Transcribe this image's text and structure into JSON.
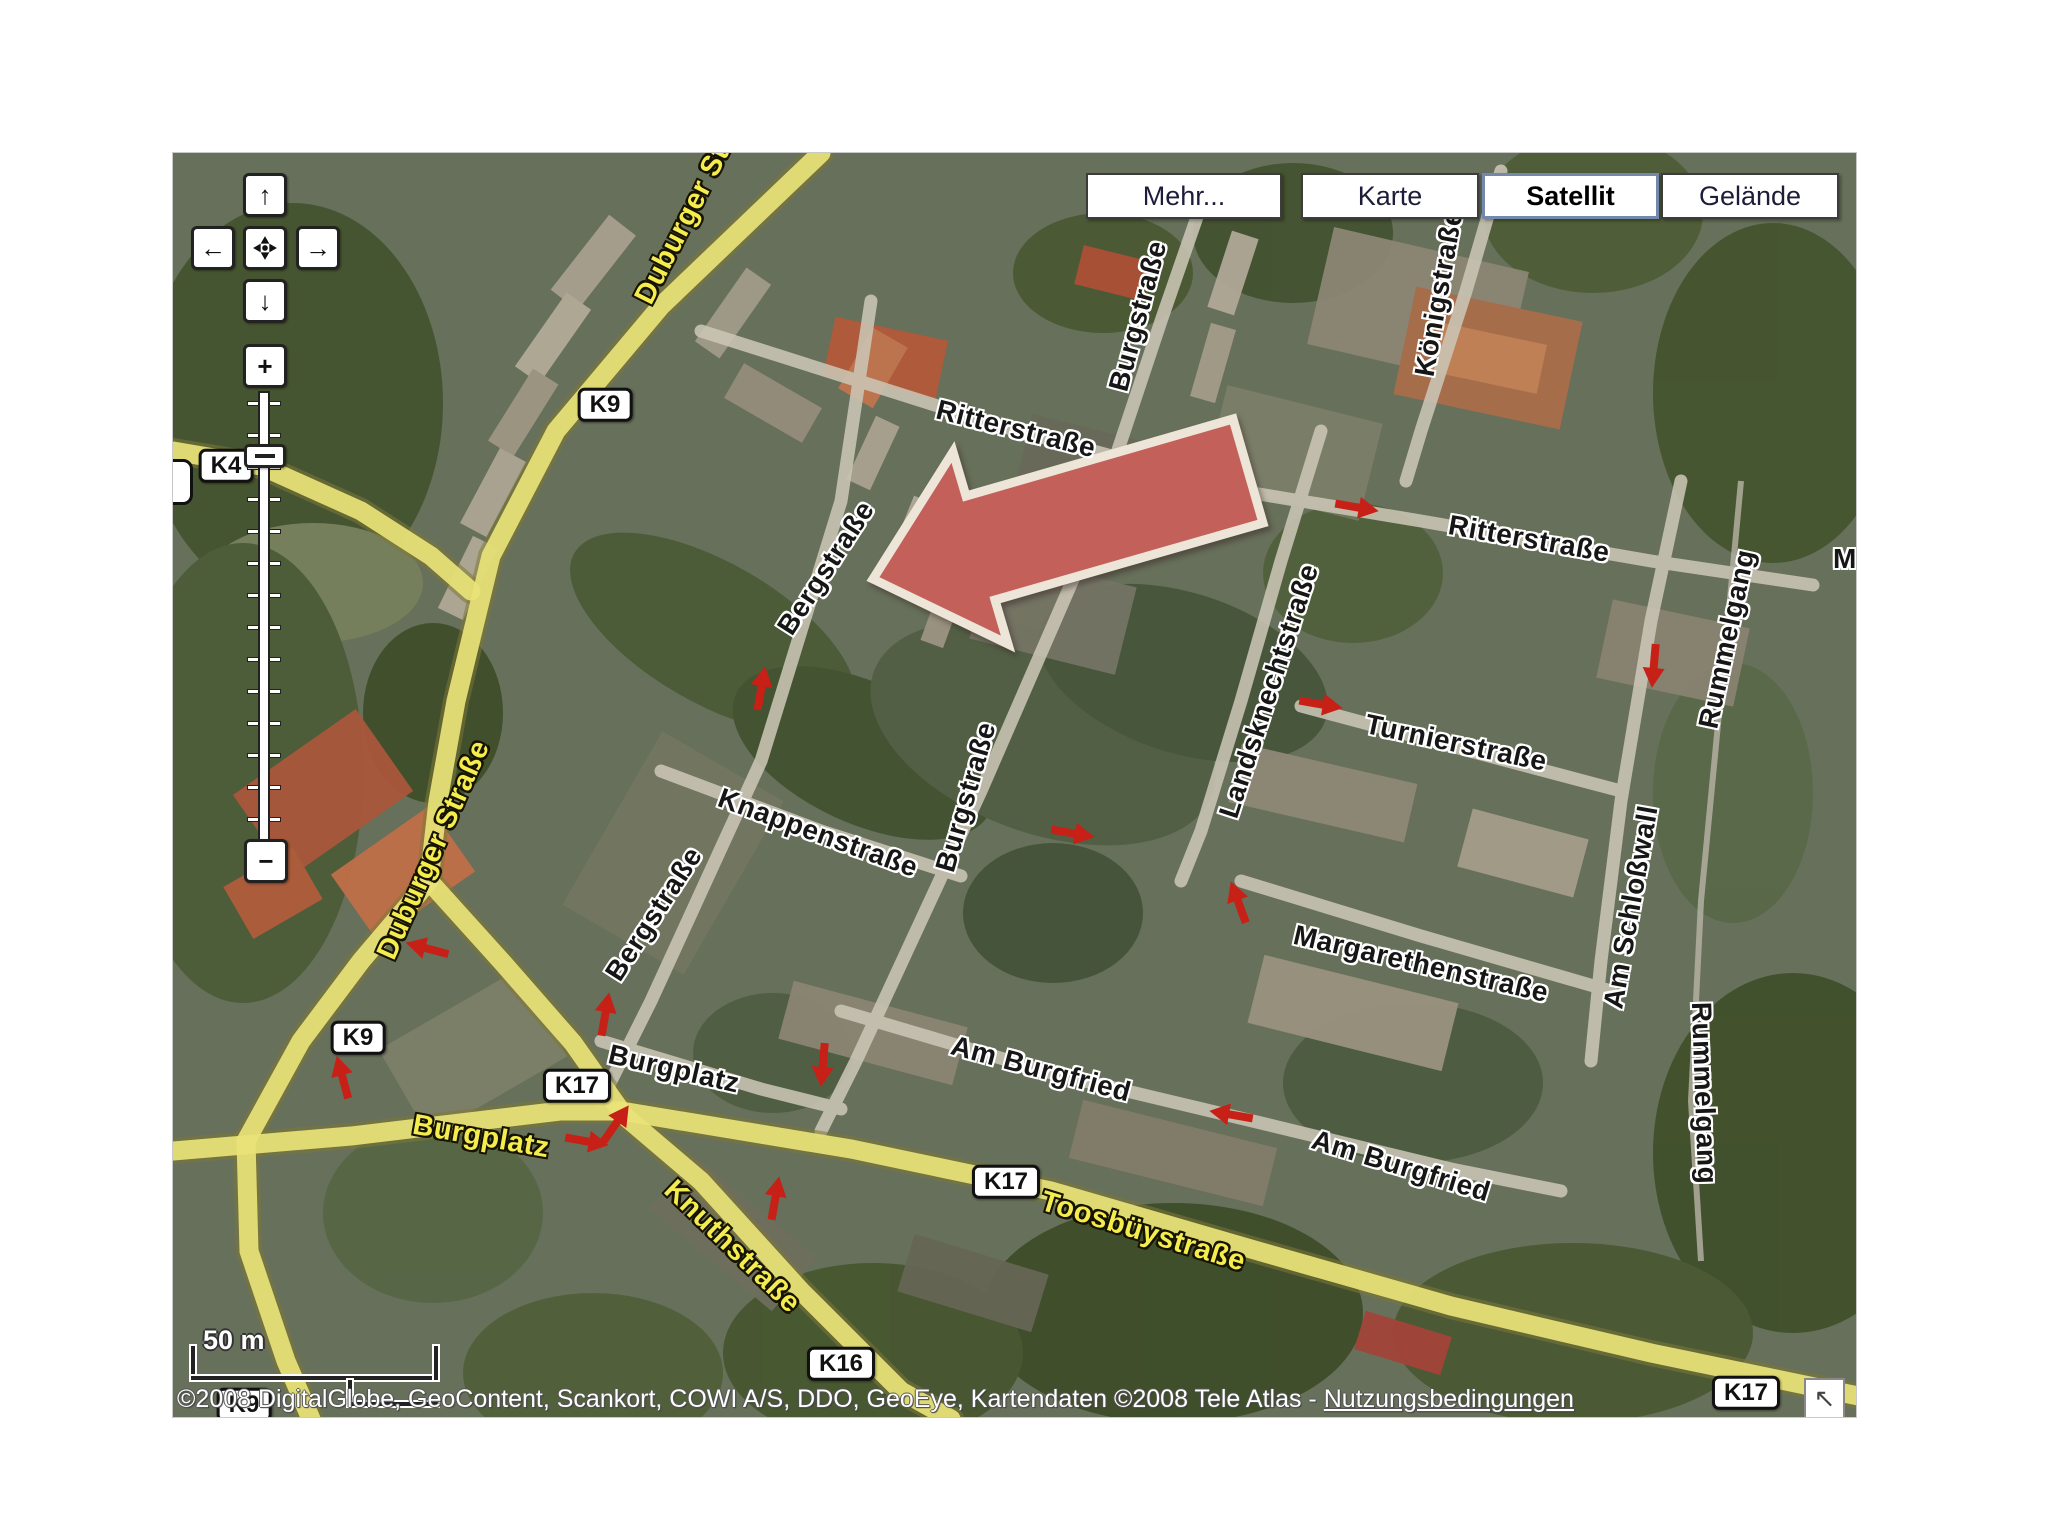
{
  "layer_buttons": [
    {
      "id": "mehr",
      "label": "Mehr...",
      "x": 913,
      "w": 196,
      "selected": false
    },
    {
      "id": "karte",
      "label": "Karte",
      "x": 1128,
      "w": 178,
      "selected": false
    },
    {
      "id": "satellit",
      "label": "Satellit",
      "x": 1309,
      "w": 177,
      "selected": true
    },
    {
      "id": "gelaende",
      "label": "Gelände",
      "x": 1488,
      "w": 178,
      "selected": false
    }
  ],
  "pan_control": {
    "up": "↑",
    "left": "←",
    "right": "→",
    "down": "↓",
    "zoom_in": "+",
    "zoom_out": "−"
  },
  "street_labels": [
    {
      "name": "duburger-strasse-top",
      "text": "Duburger Straße",
      "x": 524,
      "y": 44,
      "rot": -63,
      "style": "yellow"
    },
    {
      "name": "duburger-strasse",
      "text": "Duburger Straße",
      "x": 261,
      "y": 697,
      "rot": -66,
      "style": "yellow"
    },
    {
      "name": "burgplatz-yellow",
      "text": "Burgplatz",
      "x": 308,
      "y": 984,
      "rot": 10,
      "style": "yellow"
    },
    {
      "name": "knuthstrasse",
      "text": "Knuthstraße",
      "x": 559,
      "y": 1094,
      "rot": 44,
      "style": "yellow"
    },
    {
      "name": "toosbuystrasse",
      "text": "Toosbüystraße",
      "x": 970,
      "y": 1079,
      "rot": 17,
      "style": "yellow"
    },
    {
      "name": "ritterstrasse-west",
      "text": "Ritterstraße",
      "x": 843,
      "y": 276,
      "rot": 14,
      "style": "white"
    },
    {
      "name": "ritterstrasse-east",
      "text": "Ritterstraße",
      "x": 1356,
      "y": 386,
      "rot": 10,
      "style": "white"
    },
    {
      "name": "bergstrasse-north",
      "text": "Bergstraße",
      "x": 653,
      "y": 415,
      "rot": -57,
      "style": "white"
    },
    {
      "name": "bergstrasse-south",
      "text": "Bergstraße",
      "x": 481,
      "y": 761,
      "rot": -57,
      "style": "white"
    },
    {
      "name": "burgstrasse-north",
      "text": "Burgstraße",
      "x": 965,
      "y": 163,
      "rot": -75,
      "style": "white"
    },
    {
      "name": "burgstrasse-mid",
      "text": "Burgstraße",
      "x": 793,
      "y": 644,
      "rot": -74,
      "style": "white"
    },
    {
      "name": "koenigstrasse",
      "text": "Königstraße",
      "x": 1266,
      "y": 140,
      "rot": -80,
      "style": "white"
    },
    {
      "name": "landsknechtstrasse",
      "text": "Landsknechtstraße",
      "x": 1096,
      "y": 538,
      "rot": -72,
      "style": "white"
    },
    {
      "name": "turnierstrasse",
      "text": "Turnierstraße",
      "x": 1283,
      "y": 590,
      "rot": 12,
      "style": "white"
    },
    {
      "name": "margarethenstrasse",
      "text": "Margarethenstraße",
      "x": 1248,
      "y": 811,
      "rot": 13,
      "style": "white"
    },
    {
      "name": "am-schlosswall",
      "text": "Am Schloßwall",
      "x": 1458,
      "y": 754,
      "rot": -80,
      "style": "white"
    },
    {
      "name": "rummelgang-north",
      "text": "Rummelgang",
      "x": 1554,
      "y": 486,
      "rot": -78,
      "style": "white"
    },
    {
      "name": "rummelgang-south",
      "text": "Rummelgang",
      "x": 1531,
      "y": 940,
      "rot": 88,
      "style": "white"
    },
    {
      "name": "knappenstrasse",
      "text": "Knappenstraße",
      "x": 645,
      "y": 680,
      "rot": 20,
      "style": "white"
    },
    {
      "name": "burgplatz-white",
      "text": "Burgplatz",
      "x": 501,
      "y": 916,
      "rot": 13,
      "style": "white"
    },
    {
      "name": "am-burgfried-west",
      "text": "Am Burgfried",
      "x": 868,
      "y": 916,
      "rot": 15,
      "style": "white"
    },
    {
      "name": "am-burgfried-east",
      "text": "Am Burgfried",
      "x": 1228,
      "y": 1013,
      "rot": 17,
      "style": "white"
    },
    {
      "name": "edge-fragment-ma",
      "text": "Ma",
      "x": 1680,
      "y": 406,
      "rot": 0,
      "style": "white"
    }
  ],
  "road_badges": [
    {
      "name": "k9-north",
      "text": "K9",
      "x": 432,
      "y": 252
    },
    {
      "name": "k4-west",
      "text": "K4",
      "x": 53,
      "y": 313
    },
    {
      "name": "k9-mid",
      "text": "K9",
      "x": 185,
      "y": 885
    },
    {
      "name": "k17-burgplatz",
      "text": "K17",
      "x": 404,
      "y": 933
    },
    {
      "name": "k17-toosbuy",
      "text": "K17",
      "x": 833,
      "y": 1029
    },
    {
      "name": "k16",
      "text": "K16",
      "x": 668,
      "y": 1211
    },
    {
      "name": "k17-southeast",
      "text": "K17",
      "x": 1573,
      "y": 1240
    },
    {
      "name": "k9-south",
      "text": "K9",
      "x": 71,
      "y": 1252
    }
  ],
  "oneway_arrows": [
    {
      "x": 256,
      "y": 796,
      "rot": 195
    },
    {
      "x": 170,
      "y": 926,
      "rot": 255
    },
    {
      "x": 432,
      "y": 863,
      "rot": 280
    },
    {
      "x": 650,
      "y": 910,
      "rot": 95
    },
    {
      "x": 898,
      "y": 680,
      "rot": 10
    },
    {
      "x": 1182,
      "y": 354,
      "rot": 10
    },
    {
      "x": 442,
      "y": 972,
      "rot": 305
    },
    {
      "x": 412,
      "y": 988,
      "rot": 10
    },
    {
      "x": 602,
      "y": 1047,
      "rot": 280
    },
    {
      "x": 1060,
      "y": 962,
      "rot": 190
    },
    {
      "x": 1146,
      "y": 551,
      "rot": 10
    },
    {
      "x": 1481,
      "y": 511,
      "rot": 95
    },
    {
      "x": 1066,
      "y": 751,
      "rot": 250
    },
    {
      "x": 588,
      "y": 537,
      "rot": 280
    }
  ],
  "oneway_color": "#c62017",
  "big_arrow": {
    "fill": "#c4605a",
    "stroke": "#ece5d8",
    "points": [
      [
        700,
        426
      ],
      [
        780,
        299
      ],
      [
        793,
        343
      ],
      [
        1060,
        266
      ],
      [
        1090,
        370
      ],
      [
        822,
        447
      ],
      [
        835,
        491
      ]
    ]
  },
  "scale_bar": {
    "label": "50 m"
  },
  "copyright": {
    "prefix": "©2008 DigitalGlobe, GeoContent, Scankort, COWI A/S, DDO, GeoEye, Kartendaten ©2008 Tele Atlas - ",
    "link": "Nutzungsbedingungen"
  },
  "corner_button": {
    "icon": "↖"
  }
}
